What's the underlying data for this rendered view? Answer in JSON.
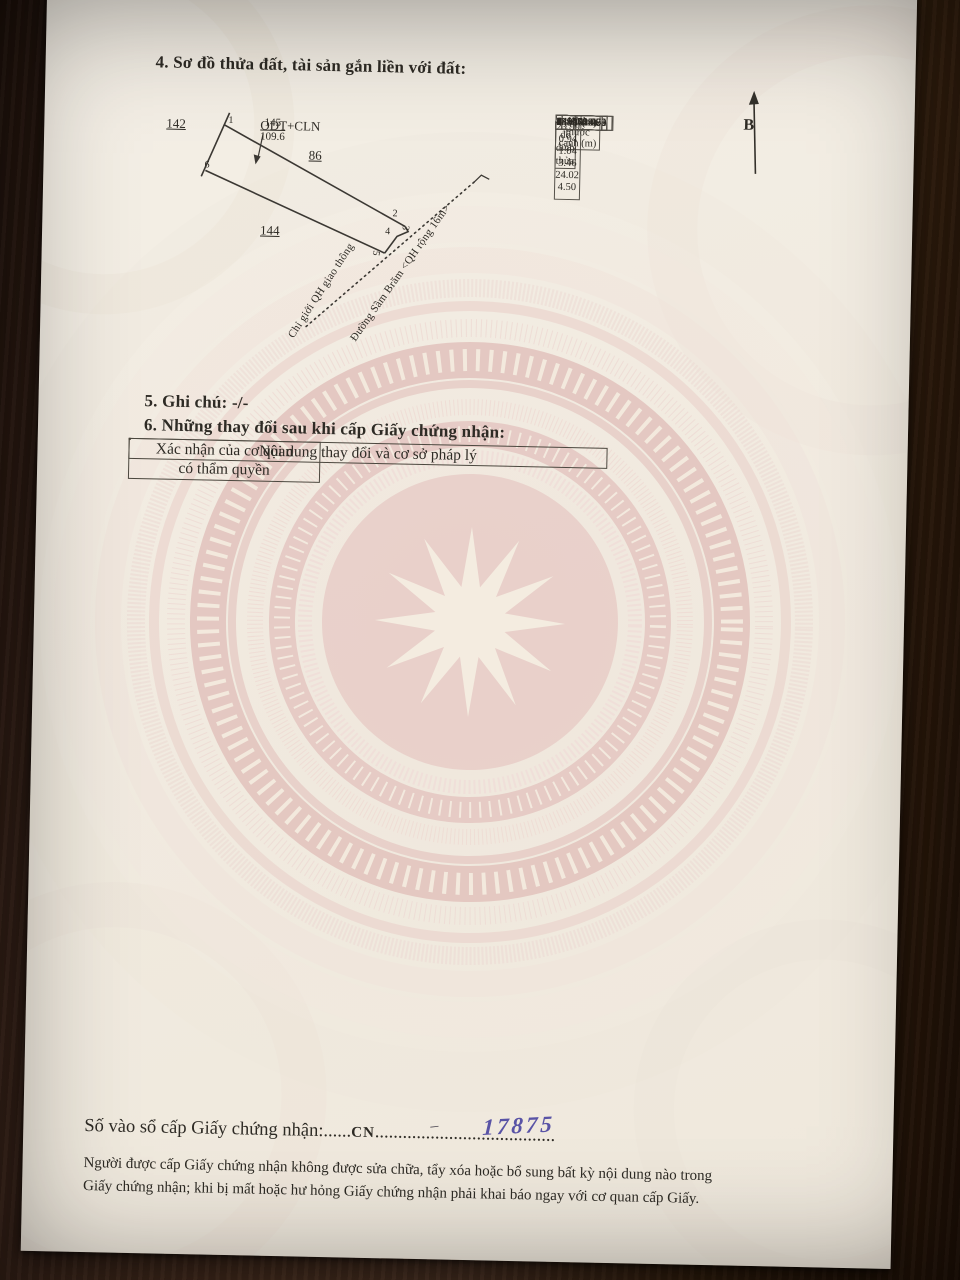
{
  "sections": {
    "s4_title": "4. Sơ đồ thửa đất, tài sản gắn liền với đất:",
    "s5_title": "5. Ghi chú: -/-",
    "s6_title": "6. Những thay đổi sau khi cấp Giấy chứng nhận:"
  },
  "diagram": {
    "north_label": "B",
    "adjacent_parcel_left": "142",
    "adjacent_parcel_bottom": "144",
    "inner_parcel": "86",
    "land_use_code": "ODT+CLN",
    "parcel_number": "145",
    "parcel_area": "109.6",
    "vertices": [
      "1",
      "2",
      "3",
      "4",
      "5",
      "6"
    ],
    "planning_boundary_label": "Chỉ giới QH giao thông",
    "road_label": "Đường Sầm Brăm <QH rộng 16m>"
  },
  "coord_table": {
    "title": "Tọa độ đỉnh thửa",
    "headers": {
      "vertex": "Đỉnh",
      "x": "X (m)",
      "y": "Y (m)",
      "edge_line1": "Kích thước",
      "edge_line2": "cạnh (m)"
    },
    "rows": [
      [
        "1",
        "1399739.89",
        "448142.09"
      ],
      [
        "2",
        "1399728.94",
        "448163.45"
      ],
      [
        "3",
        "1399728.52",
        "448164.28"
      ],
      [
        "4",
        "1399727.65",
        "448163.72"
      ],
      [
        "5",
        "1399724.75",
        "448161.83"
      ],
      [
        "6",
        "1399735.70",
        "448140.45"
      ],
      [
        "1",
        "1399739.89",
        "448142.09"
      ]
    ],
    "edge_lengths": [
      "23.99",
      "0.94",
      "1.04",
      "3.46",
      "24.02",
      "4.50"
    ]
  },
  "changes_table": {
    "col1_header": "Nội dung thay đổi và cơ sở pháp lý",
    "col2_header_line1": "Xác nhận của cơ quan",
    "col2_header_line2": "có thẩm quyền"
  },
  "serial": {
    "label": "Số vào sổ cấp Giấy chứng nhận:",
    "dots_before": "......",
    "prefix": "CN",
    "dots_after": ".......................................",
    "handwritten_dash": "–",
    "handwritten_number": "17875"
  },
  "footer": {
    "line1": "Người được cấp Giấy chứng nhận không được sửa chữa, tẩy xóa hoặc bổ sung bất kỳ nội dung nào trong",
    "line2": "Giấy chứng nhận; khi bị mất hoặc hư hỏng Giấy chứng nhận phải khai báo ngay với cơ quan cấp Giấy."
  },
  "colors": {
    "ink": "#2e2b25",
    "handwriting_ink": "#5953a6",
    "paper": "#f2ece1",
    "drum_pink": "#e4c6c1",
    "wood_brown": "#4c3121"
  }
}
